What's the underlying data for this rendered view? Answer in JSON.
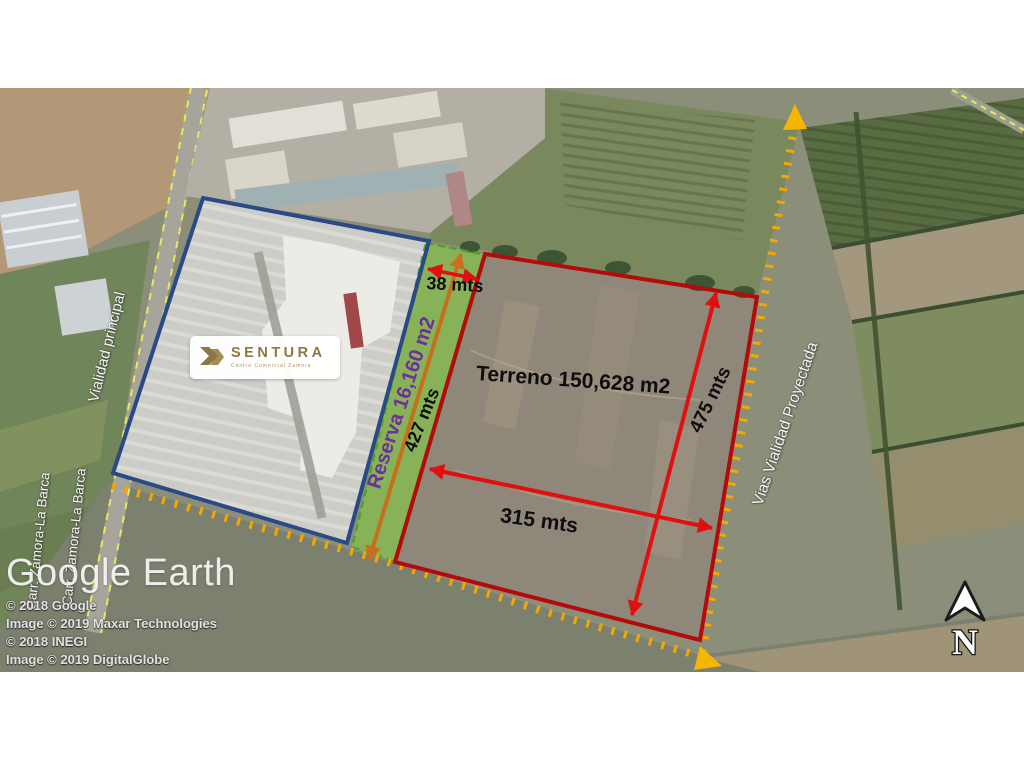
{
  "brand_box": {
    "name": "SENTURA",
    "tagline": "Centro Comercial Zamora"
  },
  "parcels": {
    "terreno_label": "Terreno 150,628 m2",
    "reserva_label": "Reserva 16,160 m2"
  },
  "measurements": {
    "reserva_length": "427 mts",
    "reserva_width": "38 mts",
    "terreno_width": "315 mts",
    "terreno_length": "475 mts"
  },
  "roads": {
    "main": "Vialidad principal",
    "highway_a": "Carr. Zamora-La Barca",
    "highway_b": "Carr. Zamora-La Barca",
    "projected": "Vias Vialidad Proyectada"
  },
  "watermark": "Google Earth",
  "credits": [
    "© 2018 Google",
    "Image © 2019 Maxar Technologies",
    "© 2018 INEGI",
    "Image © 2019 DigitalGlobe"
  ],
  "compass": {
    "north": "N"
  },
  "colors": {
    "terreno_outline": "#b40a0a",
    "measure_arrow": "#e01010",
    "reserva_fill": "#86cf3e",
    "reserva_arrow": "#c86f1e",
    "reserva_text": "#6d2f9c",
    "mall_outline": "#2a4a85",
    "projected_road_dots": "#f2a800",
    "brand_gold": "#8e7743"
  }
}
